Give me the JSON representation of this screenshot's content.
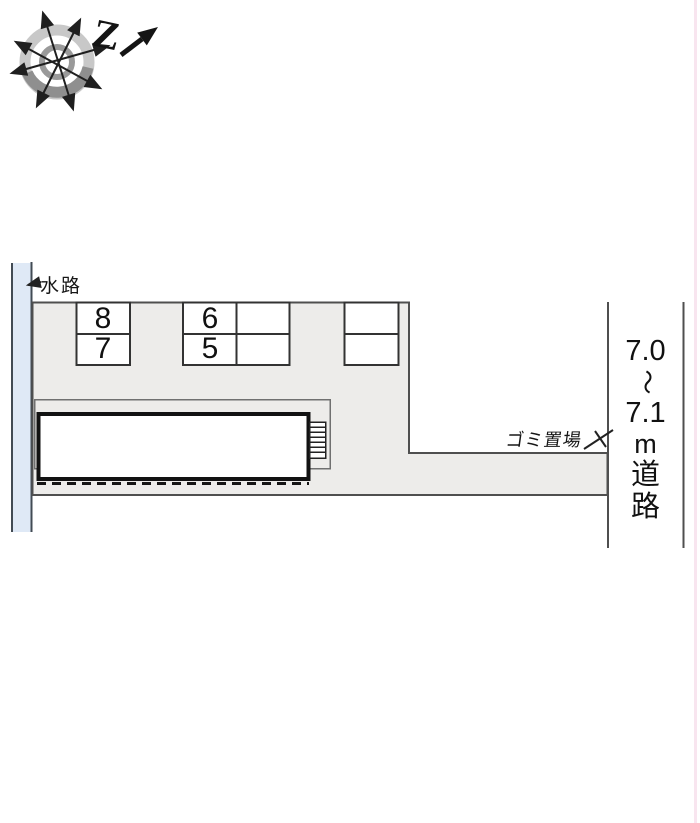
{
  "canvas": {
    "width": 700,
    "height": 823,
    "background": "#ffffff"
  },
  "colors": {
    "site_area_fill": "#edecea",
    "water_channel_fill": "#dfe9f6",
    "outline_line": "#4f4f4f",
    "water_line": "#424b54",
    "stall_line": "#333333",
    "building_line": "#121212",
    "compass_ring_light": "#c8c8c8",
    "compass_ring_dark": "#8f8f8f",
    "text": "#161616"
  },
  "compass": {
    "north_label": "Z"
  },
  "labels": {
    "waterway": "水路",
    "garbage_area": "ゴミ置場",
    "road": {
      "full": "7.0～7.1m道路",
      "chars": [
        "7.0",
        "～",
        "7.1",
        "m",
        "道",
        "路"
      ]
    }
  },
  "parking": {
    "stall_numbers_left": [
      "8",
      "7"
    ],
    "stall_numbers_middle": [
      "6",
      "5"
    ],
    "empty_stalls_middle": [
      "",
      ""
    ],
    "empty_stalls_right": [
      "",
      ""
    ]
  }
}
